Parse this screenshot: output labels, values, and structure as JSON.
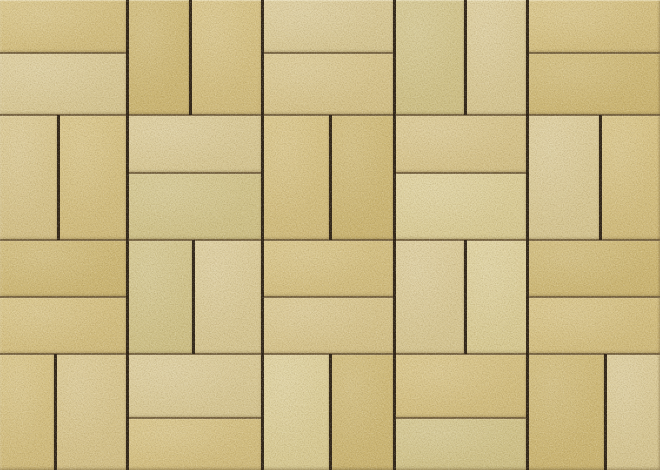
{
  "image": {
    "description": "Close-up photo of sand/buff colored rectangular concrete pavers laid in a basketweave pattern, seen straight from above. Pairs of bricks alternate between horizontal and vertical orientation in a 5x4 grid of square units. Vertical joints are deep dark-brown shadow lines; horizontal joints are thinner and lighter brown. The brick surfaces have a fine speckled sand-grain texture with subtle tonal differences between bricks and pale beveled edges.",
    "width_px": 660,
    "height_px": 470
  },
  "pavers": {
    "pattern_type": "basketweave",
    "unit_px": 131,
    "grid": {
      "cols": 5,
      "rows": 4,
      "row_pattern": [
        "H V H V H",
        "V H V H V",
        "H V H V H",
        "V H V H V"
      ]
    },
    "colors": {
      "joint_horizontal": "#6e5b3a",
      "joint_vertical": "#2b2013",
      "brick_average": "#d8c68c",
      "edge_highlight": "#fef9e4",
      "edge_shade": "#604c28"
    },
    "palette": [
      {
        "base": "#dac78c",
        "shade": "#d0bb7c"
      },
      {
        "base": "#decfa0",
        "shade": "#d5c591"
      },
      {
        "base": "#d3bf80",
        "shade": "#cbb572"
      },
      {
        "base": "#dccb97",
        "shade": "#d3c087"
      },
      {
        "base": "#d6c994",
        "shade": "#cec086"
      },
      {
        "base": "#e0d3a2",
        "shade": "#d7c992"
      }
    ],
    "bricks": [
      [
        0,
        0,
        127,
        53,
        0
      ],
      [
        0,
        53,
        127,
        62,
        1
      ],
      [
        127,
        0,
        63,
        115,
        2
      ],
      [
        190,
        0,
        72,
        115,
        0
      ],
      [
        262,
        0,
        132,
        53,
        1
      ],
      [
        262,
        53,
        132,
        62,
        3
      ],
      [
        394,
        0,
        71,
        115,
        4
      ],
      [
        465,
        0,
        62,
        115,
        1
      ],
      [
        527,
        0,
        133,
        53,
        0
      ],
      [
        527,
        53,
        133,
        62,
        2
      ],
      [
        0,
        115,
        58,
        125,
        3
      ],
      [
        58,
        115,
        69,
        125,
        0
      ],
      [
        127,
        115,
        135,
        58,
        1
      ],
      [
        127,
        173,
        135,
        67,
        4
      ],
      [
        262,
        115,
        68,
        125,
        0
      ],
      [
        330,
        115,
        64,
        125,
        2
      ],
      [
        394,
        115,
        133,
        58,
        3
      ],
      [
        394,
        173,
        133,
        67,
        5
      ],
      [
        527,
        115,
        73,
        125,
        1
      ],
      [
        600,
        115,
        60,
        125,
        0
      ],
      [
        0,
        240,
        127,
        57,
        2
      ],
      [
        0,
        297,
        127,
        57,
        0
      ],
      [
        127,
        240,
        66,
        114,
        4
      ],
      [
        193,
        240,
        69,
        114,
        1
      ],
      [
        262,
        240,
        132,
        57,
        0
      ],
      [
        262,
        297,
        132,
        57,
        3
      ],
      [
        394,
        240,
        71,
        114,
        1
      ],
      [
        465,
        240,
        72,
        114,
        5
      ],
      [
        527,
        240,
        133,
        57,
        2
      ],
      [
        527,
        297,
        133,
        57,
        0
      ],
      [
        0,
        354,
        55,
        116,
        0
      ],
      [
        55,
        354,
        72,
        116,
        3
      ],
      [
        127,
        354,
        135,
        64,
        1
      ],
      [
        127,
        418,
        135,
        52,
        0
      ],
      [
        262,
        354,
        68,
        116,
        5
      ],
      [
        330,
        354,
        64,
        116,
        2
      ],
      [
        394,
        354,
        133,
        64,
        0
      ],
      [
        394,
        418,
        133,
        52,
        4
      ],
      [
        527,
        354,
        78,
        116,
        2
      ],
      [
        605,
        354,
        55,
        116,
        1
      ]
    ],
    "joints": {
      "horizontal_segments": [
        [
          0,
          53,
          127
        ],
        [
          262,
          53,
          394
        ],
        [
          527,
          53,
          660
        ],
        [
          0,
          115,
          660
        ],
        [
          127,
          173,
          262
        ],
        [
          394,
          173,
          527
        ],
        [
          0,
          240,
          660
        ],
        [
          0,
          297,
          127
        ],
        [
          262,
          297,
          394
        ],
        [
          527,
          297,
          660
        ],
        [
          0,
          354,
          660
        ],
        [
          127,
          418,
          262
        ],
        [
          394,
          418,
          527
        ]
      ],
      "vertical_segments": [
        [
          127,
          0,
          470
        ],
        [
          262,
          0,
          470
        ],
        [
          394,
          0,
          470
        ],
        [
          527,
          0,
          470
        ],
        [
          190,
          0,
          115
        ],
        [
          465,
          0,
          115
        ],
        [
          58,
          115,
          240
        ],
        [
          330,
          115,
          240
        ],
        [
          600,
          115,
          240
        ],
        [
          193,
          240,
          354
        ],
        [
          465,
          240,
          354
        ],
        [
          55,
          354,
          470
        ],
        [
          330,
          354,
          470
        ],
        [
          605,
          354,
          470
        ]
      ]
    }
  }
}
